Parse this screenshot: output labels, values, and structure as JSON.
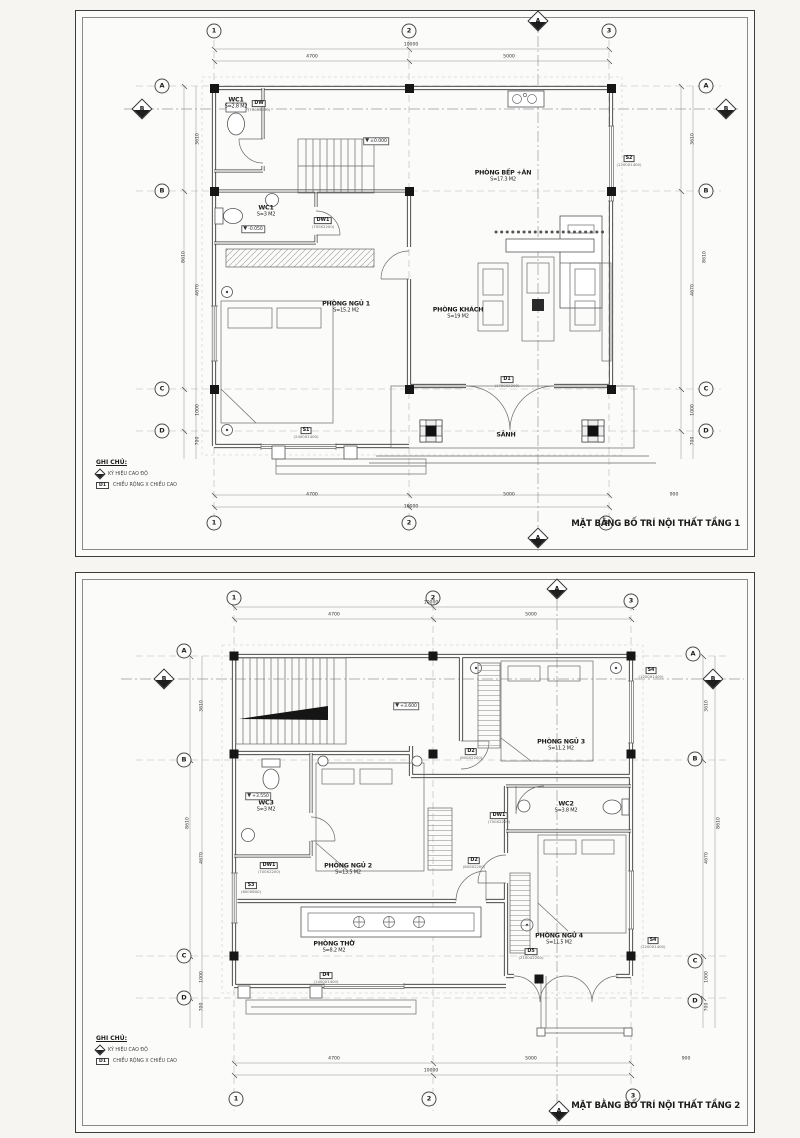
{
  "accent_colors": {
    "line": "#2e2e2e",
    "paper": "#fbfbf9",
    "column_fill": "#161616"
  },
  "sheets": [
    {
      "title": "MẶT BẰNG BỐ TRÍ NỘI THẤT  TẦNG 1",
      "bubbles": [
        {
          "x": 138,
          "y": 20,
          "label": "1"
        },
        {
          "x": 333,
          "y": 20,
          "label": "2"
        },
        {
          "x": 533,
          "y": 20,
          "label": "3"
        },
        {
          "x": 138,
          "y": 512,
          "label": "1"
        },
        {
          "x": 333,
          "y": 512,
          "label": "2"
        },
        {
          "x": 530,
          "y": 512,
          "label": "3"
        },
        {
          "x": 86,
          "y": 75,
          "label": "A"
        },
        {
          "x": 86,
          "y": 180,
          "label": "B"
        },
        {
          "x": 86,
          "y": 378,
          "label": "C"
        },
        {
          "x": 86,
          "y": 420,
          "label": "D"
        },
        {
          "x": 630,
          "y": 75,
          "label": "A"
        },
        {
          "x": 630,
          "y": 180,
          "label": "B"
        },
        {
          "x": 630,
          "y": 378,
          "label": "C"
        },
        {
          "x": 630,
          "y": 420,
          "label": "D"
        }
      ],
      "diamonds": [
        {
          "x": 462,
          "y": 10,
          "label": "A"
        },
        {
          "x": 462,
          "y": 527,
          "label": "A"
        },
        {
          "x": 66,
          "y": 98,
          "label": "B"
        },
        {
          "x": 650,
          "y": 98,
          "label": "B"
        }
      ],
      "rooms": [
        {
          "x": 160,
          "y": 92,
          "name": "WC1",
          "area": "S=2.8 M2"
        },
        {
          "x": 190,
          "y": 200,
          "name": "WC1",
          "area": "S=3 M2"
        },
        {
          "x": 270,
          "y": 296,
          "name": "PHÒNG  NGỦ 1",
          "area": "S=15.2 M2"
        },
        {
          "x": 427,
          "y": 165,
          "name": "PHÒNG BẾP +ĂN",
          "area": "S=17.3 M2"
        },
        {
          "x": 382,
          "y": 302,
          "name": "PHÒNG KHÁCH",
          "area": "S=19 M2"
        },
        {
          "x": 430,
          "y": 424,
          "name": "SẢNH",
          "area": ""
        }
      ],
      "tags": [
        {
          "x": 183,
          "y": 90,
          "label": "DW",
          "sub": "(700X2200)"
        },
        {
          "x": 247,
          "y": 207,
          "label": "DW1",
          "sub": "(700X2200)"
        },
        {
          "x": 230,
          "y": 417,
          "label": "S1",
          "sub": "(2400X1400)"
        },
        {
          "x": 553,
          "y": 145,
          "label": "S2",
          "sub": "(1200X1400)"
        },
        {
          "x": 431,
          "y": 366,
          "label": "D1",
          "sub": "(1700X2200)"
        }
      ],
      "dims": [
        {
          "x": 335,
          "y": 34,
          "label": "10000"
        },
        {
          "x": 236,
          "y": 46,
          "label": "4700"
        },
        {
          "x": 433,
          "y": 46,
          "label": "5000"
        },
        {
          "x": 236,
          "y": 484,
          "label": "4700"
        },
        {
          "x": 433,
          "y": 484,
          "label": "5000"
        },
        {
          "x": 335,
          "y": 496,
          "label": "10000"
        },
        {
          "x": 598,
          "y": 484,
          "label": "900"
        },
        {
          "x": 108,
          "y": 246,
          "label": "8610",
          "cls": "v"
        },
        {
          "x": 122,
          "y": 128,
          "label": "3610",
          "cls": "v"
        },
        {
          "x": 122,
          "y": 279,
          "label": "4670",
          "cls": "v"
        },
        {
          "x": 122,
          "y": 399,
          "label": "1000",
          "cls": "v"
        },
        {
          "x": 122,
          "y": 430,
          "label": "700",
          "cls": "v"
        },
        {
          "x": 617,
          "y": 128,
          "label": "3610",
          "cls": "v"
        },
        {
          "x": 617,
          "y": 279,
          "label": "4670",
          "cls": "v"
        },
        {
          "x": 629,
          "y": 246,
          "label": "8610",
          "cls": "v"
        },
        {
          "x": 617,
          "y": 399,
          "label": "1000",
          "cls": "v"
        },
        {
          "x": 617,
          "y": 430,
          "label": "700",
          "cls": "v"
        }
      ],
      "elevations": [
        {
          "x": 300,
          "y": 130,
          "label": "±0.000"
        },
        {
          "x": 177,
          "y": 218,
          "label": "-0.050"
        }
      ],
      "notes": {
        "heading": "GHI CHÚ:",
        "line1": "KÝ HIỆU CAO ĐỘ",
        "line2": "CHIỀU RỘNG X CHIỀU CAO",
        "tag": "D1"
      }
    },
    {
      "title": "MẶT BẰNG BỐ TRÍ NỘI THẤT  TẦNG 2",
      "bubbles": [
        {
          "x": 158,
          "y": 25,
          "label": "1"
        },
        {
          "x": 357,
          "y": 25,
          "label": "2"
        },
        {
          "x": 555,
          "y": 28,
          "label": "3"
        },
        {
          "x": 160,
          "y": 526,
          "label": "1"
        },
        {
          "x": 353,
          "y": 526,
          "label": "2"
        },
        {
          "x": 557,
          "y": 523,
          "label": "3"
        },
        {
          "x": 108,
          "y": 78,
          "label": "A"
        },
        {
          "x": 108,
          "y": 187,
          "label": "B"
        },
        {
          "x": 108,
          "y": 383,
          "label": "C"
        },
        {
          "x": 108,
          "y": 425,
          "label": "D"
        },
        {
          "x": 617,
          "y": 81,
          "label": "A"
        },
        {
          "x": 619,
          "y": 186,
          "label": "B"
        },
        {
          "x": 619,
          "y": 388,
          "label": "C"
        },
        {
          "x": 619,
          "y": 428,
          "label": "D"
        }
      ],
      "diamonds": [
        {
          "x": 481,
          "y": 16,
          "label": "A"
        },
        {
          "x": 483,
          "y": 538,
          "label": "A"
        },
        {
          "x": 88,
          "y": 106,
          "label": "B"
        },
        {
          "x": 637,
          "y": 106,
          "label": "B"
        }
      ],
      "rooms": [
        {
          "x": 485,
          "y": 172,
          "name": "PHÒNG  NGỦ 3",
          "area": "S=11.2 M2"
        },
        {
          "x": 490,
          "y": 234,
          "name": "WC2",
          "area": "S=3.8 M2"
        },
        {
          "x": 190,
          "y": 233,
          "name": "WC3",
          "area": "S=3 M2"
        },
        {
          "x": 272,
          "y": 296,
          "name": "PHÒNG  NGỦ 2",
          "area": "S=13.5 M2"
        },
        {
          "x": 258,
          "y": 374,
          "name": "PHÒNG  THỜ",
          "area": "S=8.2 M2"
        },
        {
          "x": 483,
          "y": 366,
          "name": "PHÒNG  NGỦ 4",
          "area": "S=11.5 M2"
        }
      ],
      "tags": [
        {
          "x": 575,
          "y": 95,
          "label": "S4",
          "sub": "(1200X1400)"
        },
        {
          "x": 395,
          "y": 176,
          "label": "D2",
          "sub": "(800X2200)"
        },
        {
          "x": 423,
          "y": 240,
          "label": "DW1",
          "sub": "(700X2200)"
        },
        {
          "x": 398,
          "y": 285,
          "label": "D2",
          "sub": "(800X2200)"
        },
        {
          "x": 193,
          "y": 290,
          "label": "DW1",
          "sub": "(700X2200)"
        },
        {
          "x": 175,
          "y": 310,
          "label": "S3",
          "sub": "(600X600)"
        },
        {
          "x": 455,
          "y": 376,
          "label": "D5",
          "sub": "(2100X2200)"
        },
        {
          "x": 577,
          "y": 365,
          "label": "S4",
          "sub": "(1200X1400)"
        },
        {
          "x": 250,
          "y": 400,
          "label": "D4",
          "sub": "(1400X1400)"
        }
      ],
      "dims": [
        {
          "x": 355,
          "y": 30,
          "label": "10000"
        },
        {
          "x": 258,
          "y": 42,
          "label": "4700"
        },
        {
          "x": 455,
          "y": 42,
          "label": "5000"
        },
        {
          "x": 258,
          "y": 486,
          "label": "4700"
        },
        {
          "x": 455,
          "y": 486,
          "label": "5000"
        },
        {
          "x": 355,
          "y": 498,
          "label": "10000"
        },
        {
          "x": 610,
          "y": 486,
          "label": "900"
        },
        {
          "x": 112,
          "y": 250,
          "label": "8610",
          "cls": "v"
        },
        {
          "x": 126,
          "y": 133,
          "label": "3610",
          "cls": "v"
        },
        {
          "x": 126,
          "y": 285,
          "label": "4670",
          "cls": "v"
        },
        {
          "x": 126,
          "y": 404,
          "label": "1000",
          "cls": "v"
        },
        {
          "x": 126,
          "y": 434,
          "label": "700",
          "cls": "v"
        },
        {
          "x": 631,
          "y": 133,
          "label": "3610",
          "cls": "v"
        },
        {
          "x": 631,
          "y": 285,
          "label": "4670",
          "cls": "v"
        },
        {
          "x": 643,
          "y": 250,
          "label": "8610",
          "cls": "v"
        },
        {
          "x": 631,
          "y": 404,
          "label": "1000",
          "cls": "v"
        },
        {
          "x": 631,
          "y": 434,
          "label": "700",
          "cls": "v"
        }
      ],
      "elevations": [
        {
          "x": 330,
          "y": 133,
          "label": "+3.600"
        },
        {
          "x": 182,
          "y": 223,
          "label": "+3.550"
        }
      ],
      "notes": {
        "heading": "GHI CHÚ:",
        "line1": "KÝ HIỆU CAO ĐỘ",
        "line2": "CHIỀU RỘNG X CHIỀU CAO",
        "tag": "D1"
      }
    }
  ]
}
